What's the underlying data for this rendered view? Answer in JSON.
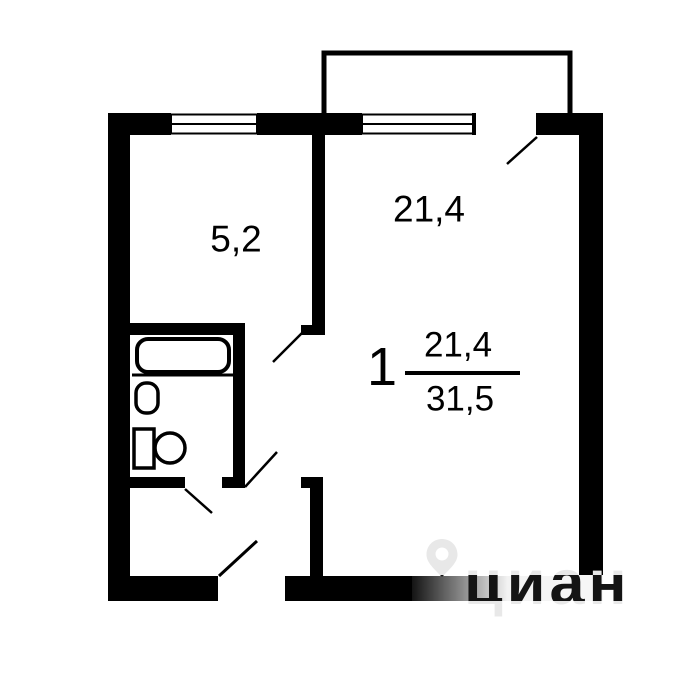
{
  "plan": {
    "title": "one-room apartment floor plan",
    "rooms": [
      {
        "id": "kitchen",
        "area_label": "5,2"
      },
      {
        "id": "living-room",
        "area_label": "21,4"
      }
    ],
    "summary": {
      "rooms_count": "1",
      "living_area": "21,4",
      "total_area": "31,5"
    },
    "features": [
      "balcony",
      "bathtub",
      "sink",
      "toilet"
    ],
    "doors": [
      "balcony-door",
      "kitchen-door",
      "living-room-door",
      "bathroom-door",
      "entrance-door"
    ]
  },
  "watermark": {
    "text": "циан",
    "icon": "map-pin"
  },
  "colors": {
    "wall": "#000000",
    "background": "#ffffff",
    "watermark_light": "#e8e8e8",
    "watermark_dark": "#141414"
  }
}
